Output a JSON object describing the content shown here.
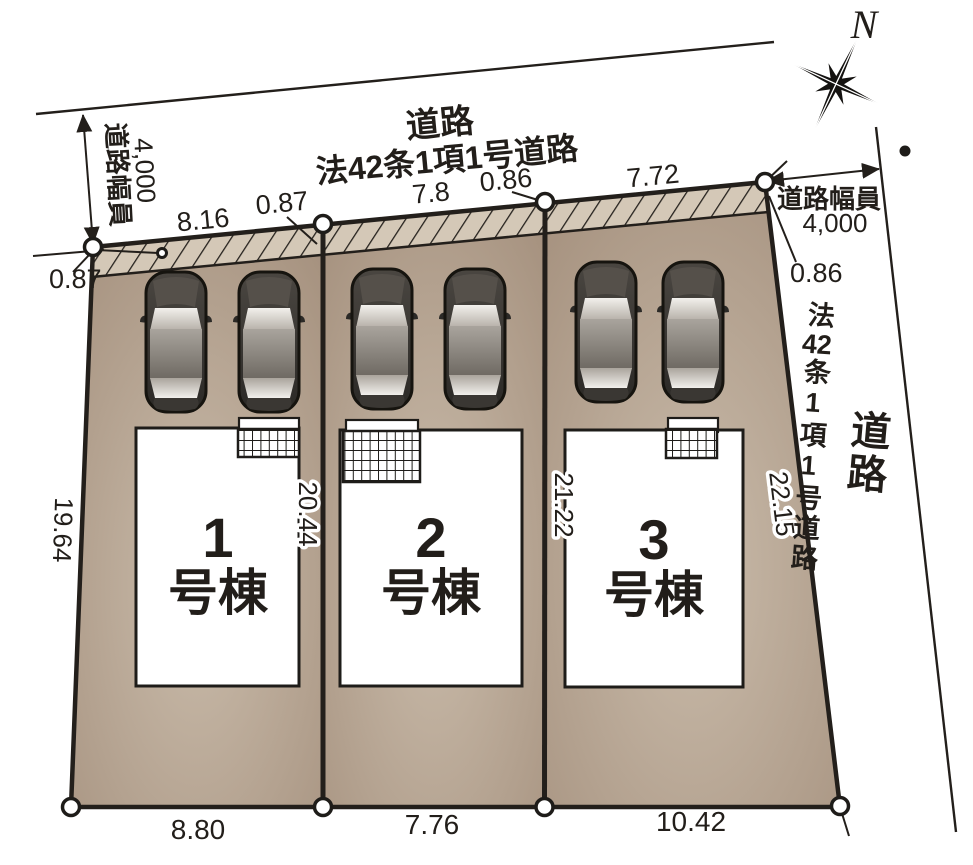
{
  "compass": {
    "north": "N"
  },
  "roads": {
    "top": {
      "name": "道路",
      "type": "法42条1項1号道路"
    },
    "right": {
      "type_p1": "法",
      "type_p2": "42",
      "type_p3": "条1項1号道路",
      "name": "道路"
    },
    "left_width": {
      "label": "道路幅員",
      "value": "4,000"
    },
    "right_width": {
      "label": "道路幅員",
      "value": "4,000"
    }
  },
  "dims": {
    "top": [
      "8.16",
      "0.87",
      "7.8",
      "0.86",
      "7.72"
    ],
    "bottom": [
      "8.80",
      "7.76",
      "10.42"
    ],
    "left_corner": "0.87",
    "right_corner": "0.86",
    "left_edge": "19.64",
    "divider_1": "20.44",
    "divider_2": "21.22",
    "right_edge": "22.15"
  },
  "lots": [
    {
      "number": "1",
      "suffix": "号棟"
    },
    {
      "number": "2",
      "suffix": "号棟"
    },
    {
      "number": "3",
      "suffix": "号棟"
    }
  ],
  "colors": {
    "lot_dark": "#a18c79",
    "lot_light": "#cabcab",
    "hatch_fill": "#d4c8b7",
    "line": "#231f1b"
  }
}
